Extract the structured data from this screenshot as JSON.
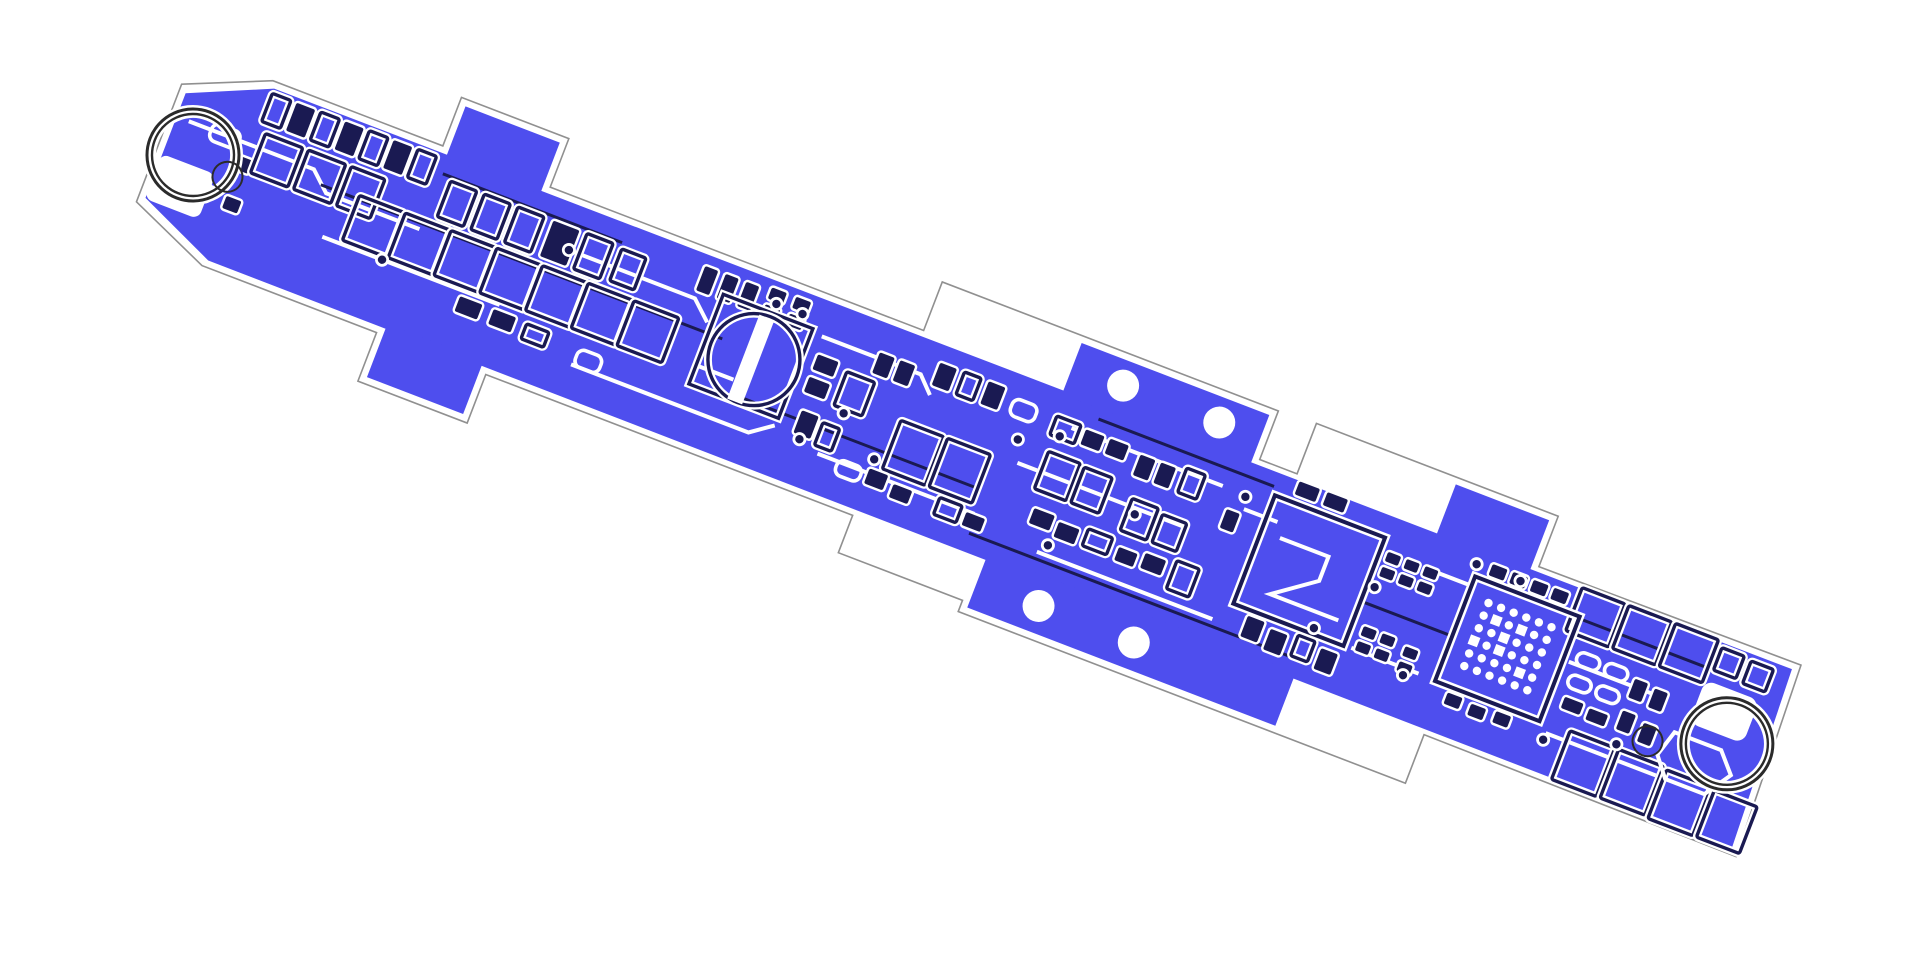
{
  "colors": {
    "background": "#ffffff",
    "copper": "#4e4eee",
    "dark": "#1a1a52",
    "silk": "#ffffff",
    "edge": "#909090",
    "ring": "#2b2b2b",
    "bare": "#ffffff"
  },
  "board": {
    "origin": {
      "x": 193,
      "y": 155
    },
    "rotation_deg": 21,
    "outline_path": "M -36,-62 L 48,-98 L 230,-98 L 230,-150 L 345,-150 L 345,-98 L 745,-98 L 745,-150 L 1105,-150 L 1105,-98 L 1145,-98 L 1145,-152 L 1404,-152 L 1404,-98 L 1684,-100 L 1692,102 L 1357,100 L 1357,152 L 878,152 L 878,140 L 745,140 L 745,100 L 352,100 L 352,152 L 235,152 L 235,100 L 48,100 L -36,64 Z",
    "copper_paths": [
      "M -29,-55 L 52,-91 L 1677,-93 L 1685,95 L 52,93 L -29,57 Z",
      "M 237,-143 L 338,-143 L 338,-88 L 237,-88 Z",
      "M 242,88 L 345,88 L 345,145 L 242,145 Z",
      "M 897,-143 L 1098,-143 L 1098,-88 L 897,-88 Z",
      "M 885,88 L 1215,88 L 1215,145 L 885,145 Z",
      "M 1297,-145 L 1397,-145 L 1397,-88 L 1297,-88 Z"
    ],
    "bare_patches": [
      [
        -30,
        10,
        58,
        48,
        8
      ],
      [
        1600,
        -52,
        58,
        46,
        10
      ]
    ],
    "holes": [
      [
        951,
        -118,
        16
      ],
      [
        1054,
        -118,
        16
      ],
      [
        951,
        118,
        16
      ],
      [
        1053,
        118,
        16
      ]
    ],
    "rings": [
      [
        0,
        0
      ],
      [
        1643,
        0
      ]
    ],
    "ring_radii": [
      46,
      41
    ],
    "small_circles": [
      [
        40,
        8,
        15
      ],
      [
        1568,
        26,
        15
      ]
    ],
    "cap": {
      "square": [
        545,
        -60,
        96,
        96
      ],
      "cx": 597,
      "cy": -10,
      "r": 46,
      "stripe": [
        586,
        -54,
        16,
        90
      ]
    },
    "soic": {
      "rect": [
        1132,
        -70,
        118,
        116
      ],
      "zigzag": [
        1152,
        -32,
        1204,
        -32,
        1204,
        -6,
        1163,
        24,
        1236,
        24
      ]
    },
    "qfn": {
      "rect": [
        1348,
        -66,
        112,
        112
      ],
      "grid_origin": [
        1370,
        -46
      ],
      "rows": 6,
      "cols": 6,
      "pitch": 13.5,
      "dot_r": 4.2,
      "cells": [
        [
          1,
          1
        ],
        [
          2,
          3
        ],
        [
          3,
          1
        ],
        [
          4,
          4
        ],
        [
          2,
          2
        ],
        [
          0,
          3
        ]
      ]
    },
    "hexagon": [
      1590,
      8,
      1640,
      8,
      1658,
      28,
      1640,
      55,
      1598,
      55,
      1582,
      35
    ],
    "components": [
      [
        8,
        -38,
        30,
        18,
        "w"
      ],
      [
        2,
        22,
        30,
        18,
        "w"
      ],
      [
        46,
        26,
        16,
        13,
        "f"
      ],
      [
        40,
        -16,
        18,
        14,
        "f"
      ],
      [
        52,
        -86,
        20,
        30,
        "o"
      ],
      [
        78,
        -86,
        20,
        30,
        "f"
      ],
      [
        104,
        -86,
        20,
        30,
        "o"
      ],
      [
        130,
        -86,
        20,
        30,
        "f"
      ],
      [
        156,
        -86,
        20,
        30,
        "o"
      ],
      [
        182,
        -86,
        20,
        30,
        "f"
      ],
      [
        208,
        -86,
        20,
        30,
        "o"
      ],
      [
        60,
        -46,
        40,
        42,
        "o"
      ],
      [
        106,
        -46,
        40,
        42,
        "o"
      ],
      [
        152,
        -46,
        36,
        42,
        "o"
      ],
      [
        250,
        -68,
        28,
        38,
        "o"
      ],
      [
        286,
        -68,
        28,
        38,
        "o"
      ],
      [
        322,
        -68,
        28,
        38,
        "o"
      ],
      [
        360,
        -68,
        28,
        38,
        "f"
      ],
      [
        396,
        -68,
        28,
        38,
        "o"
      ],
      [
        434,
        -66,
        26,
        34,
        "o"
      ],
      [
        170,
        -22,
        48,
        48,
        "o"
      ],
      [
        219,
        -22,
        48,
        48,
        "o"
      ],
      [
        268,
        -22,
        48,
        48,
        "o"
      ],
      [
        317,
        -22,
        48,
        48,
        "o"
      ],
      [
        366,
        -22,
        48,
        48,
        "o"
      ],
      [
        415,
        -22,
        48,
        48,
        "o"
      ],
      [
        464,
        -22,
        48,
        48,
        "o"
      ],
      [
        300,
        36,
        24,
        16,
        "f"
      ],
      [
        336,
        36,
        24,
        16,
        "f"
      ],
      [
        372,
        38,
        24,
        16,
        "o"
      ],
      [
        430,
        42,
        26,
        18,
        "w"
      ],
      [
        518,
        -80,
        14,
        26,
        "f"
      ],
      [
        540,
        -80,
        14,
        26,
        "f"
      ],
      [
        562,
        -80,
        14,
        26,
        "f"
      ],
      [
        588,
        -84,
        16,
        12,
        "f"
      ],
      [
        588,
        -66,
        16,
        12,
        "f"
      ],
      [
        614,
        -84,
        16,
        12,
        "f"
      ],
      [
        614,
        -66,
        16,
        12,
        "f"
      ],
      [
        655,
        -38,
        22,
        16,
        "f"
      ],
      [
        655,
        -14,
        22,
        16,
        "f"
      ],
      [
        688,
        -32,
        30,
        36,
        "o"
      ],
      [
        660,
        20,
        18,
        24,
        "f"
      ],
      [
        684,
        24,
        18,
        24,
        "o"
      ],
      [
        712,
        -62,
        16,
        22,
        "f"
      ],
      [
        734,
        -62,
        16,
        22,
        "f"
      ],
      [
        756,
        -6,
        46,
        52,
        "o"
      ],
      [
        806,
        -6,
        46,
        52,
        "o"
      ],
      [
        772,
        -74,
        18,
        24,
        "f"
      ],
      [
        798,
        -74,
        18,
        24,
        "o"
      ],
      [
        824,
        -74,
        18,
        24,
        "f"
      ],
      [
        854,
        -68,
        26,
        18,
        "w"
      ],
      [
        712,
        52,
        26,
        16,
        "w"
      ],
      [
        744,
        50,
        20,
        16,
        "f"
      ],
      [
        772,
        56,
        20,
        14,
        "f"
      ],
      [
        820,
        52,
        24,
        18,
        "o"
      ],
      [
        850,
        56,
        20,
        14,
        "f"
      ],
      [
        900,
        -66,
        26,
        20,
        "o"
      ],
      [
        932,
        -64,
        20,
        16,
        "f"
      ],
      [
        958,
        -64,
        20,
        16,
        "f"
      ],
      [
        905,
        -30,
        34,
        40,
        "o"
      ],
      [
        944,
        -28,
        30,
        38,
        "o"
      ],
      [
        992,
        -60,
        16,
        22,
        "f"
      ],
      [
        1014,
        -60,
        16,
        22,
        "f"
      ],
      [
        1040,
        -64,
        20,
        26,
        "o"
      ],
      [
        1000,
        -16,
        28,
        34,
        "o"
      ],
      [
        1034,
        -12,
        26,
        30,
        "o"
      ],
      [
        912,
        28,
        22,
        16,
        "f"
      ],
      [
        940,
        32,
        22,
        16,
        "f"
      ],
      [
        970,
        28,
        26,
        18,
        "o"
      ],
      [
        1005,
        34,
        20,
        14,
        "f"
      ],
      [
        1032,
        30,
        22,
        16,
        "f"
      ],
      [
        1064,
        26,
        24,
        30,
        "o"
      ],
      [
        1092,
        -40,
        14,
        20,
        "f"
      ],
      [
        1150,
        -92,
        22,
        14,
        "f"
      ],
      [
        1180,
        -92,
        22,
        14,
        "f"
      ],
      [
        1150,
        52,
        18,
        22,
        "f"
      ],
      [
        1176,
        56,
        18,
        22,
        "f"
      ],
      [
        1204,
        52,
        18,
        22,
        "o"
      ],
      [
        1230,
        56,
        18,
        22,
        "f"
      ],
      [
        1258,
        -58,
        14,
        10,
        "f"
      ],
      [
        1278,
        -58,
        14,
        10,
        "f"
      ],
      [
        1298,
        -58,
        14,
        10,
        "f"
      ],
      [
        1258,
        -42,
        14,
        10,
        "f"
      ],
      [
        1278,
        -42,
        14,
        10,
        "f"
      ],
      [
        1298,
        -42,
        14,
        10,
        "f"
      ],
      [
        1262,
        20,
        14,
        10,
        "f"
      ],
      [
        1282,
        20,
        14,
        10,
        "f"
      ],
      [
        1262,
        36,
        14,
        10,
        "f"
      ],
      [
        1282,
        36,
        14,
        10,
        "f"
      ],
      [
        1308,
        24,
        14,
        10,
        "f"
      ],
      [
        1308,
        40,
        14,
        10,
        "f"
      ],
      [
        1360,
        -84,
        16,
        12,
        "f"
      ],
      [
        1382,
        -84,
        16,
        12,
        "f"
      ],
      [
        1404,
        -84,
        16,
        12,
        "f"
      ],
      [
        1426,
        -84,
        16,
        12,
        "f"
      ],
      [
        1364,
        52,
        16,
        12,
        "f"
      ],
      [
        1390,
        54,
        16,
        12,
        "f"
      ],
      [
        1416,
        52,
        16,
        12,
        "f"
      ],
      [
        1472,
        -34,
        24,
        14,
        "w"
      ],
      [
        1502,
        -34,
        24,
        14,
        "w"
      ],
      [
        1472,
        -10,
        24,
        14,
        "w"
      ],
      [
        1502,
        -10,
        24,
        14,
        "w"
      ],
      [
        1475,
        14,
        20,
        12,
        "f"
      ],
      [
        1502,
        16,
        20,
        12,
        "f"
      ],
      [
        1534,
        -28,
        14,
        20,
        "f"
      ],
      [
        1556,
        -26,
        14,
        20,
        "f"
      ],
      [
        1534,
        6,
        14,
        20,
        "f"
      ],
      [
        1558,
        10,
        14,
        20,
        "f"
      ],
      [
        1452,
        -94,
        46,
        46,
        "o"
      ],
      [
        1502,
        -94,
        46,
        46,
        "o"
      ],
      [
        1552,
        -94,
        46,
        46,
        "o"
      ],
      [
        1604,
        -88,
        24,
        24,
        "o"
      ],
      [
        1636,
        -86,
        24,
        24,
        "o"
      ],
      [
        1492,
        44,
        48,
        52,
        "o"
      ],
      [
        1544,
        44,
        48,
        52,
        "o"
      ],
      [
        1596,
        46,
        48,
        52,
        "o"
      ],
      [
        1648,
        48,
        46,
        50,
        "o"
      ]
    ],
    "traces_white": [
      [
        -16,
        -30,
        118,
        -30,
        138,
        -12,
        238,
        -12
      ],
      [
        150,
        30,
        340,
        30
      ],
      [
        358,
        -46,
        520,
        -46,
        540,
        -28
      ],
      [
        428,
        60,
        618,
        60,
        640,
        44
      ],
      [
        652,
        -56,
        758,
        -56,
        774,
        -40
      ],
      [
        690,
        55,
        858,
        55
      ],
      [
        880,
        -8,
        1058,
        -8
      ],
      [
        918,
        -60,
        1080,
        -60
      ],
      [
        930,
        68,
        1118,
        68
      ],
      [
        1108,
        -46,
        1144,
        -46
      ],
      [
        1258,
        45,
        1330,
        45
      ],
      [
        1300,
        -56,
        1344,
        -56
      ],
      [
        1466,
        -20,
        1560,
        -20
      ],
      [
        1470,
        55,
        1588,
        55
      ],
      [
        545,
        16,
        585,
        16
      ]
    ],
    "traces_dark": [
      [
        130,
        -18,
        560,
        -18
      ],
      [
        590,
        30,
        850,
        30
      ],
      [
        860,
        75,
        1212,
        75
      ],
      [
        940,
        -78,
        1128,
        -78
      ],
      [
        1252,
        -2,
        1348,
        -2
      ],
      [
        1460,
        -64,
        1598,
        -64
      ],
      [
        240,
        -72,
        432,
        -72
      ]
    ],
    "vias": [
      [
        598,
        -70
      ],
      [
        626,
        -70
      ],
      [
        700,
        8
      ],
      [
        745,
        40
      ],
      [
        910,
        -48
      ],
      [
        938,
        58
      ],
      [
        1008,
        -2
      ],
      [
        1105,
        -58
      ],
      [
        1258,
        -20
      ],
      [
        1316,
        52
      ],
      [
        1345,
        -78
      ],
      [
        1392,
        -78
      ],
      [
        1470,
        62
      ],
      [
        214,
        30
      ],
      [
        385,
        -46
      ],
      [
        668,
        48
      ],
      [
        1540,
        40
      ],
      [
        872,
        -30
      ],
      [
        1216,
        40
      ]
    ]
  }
}
